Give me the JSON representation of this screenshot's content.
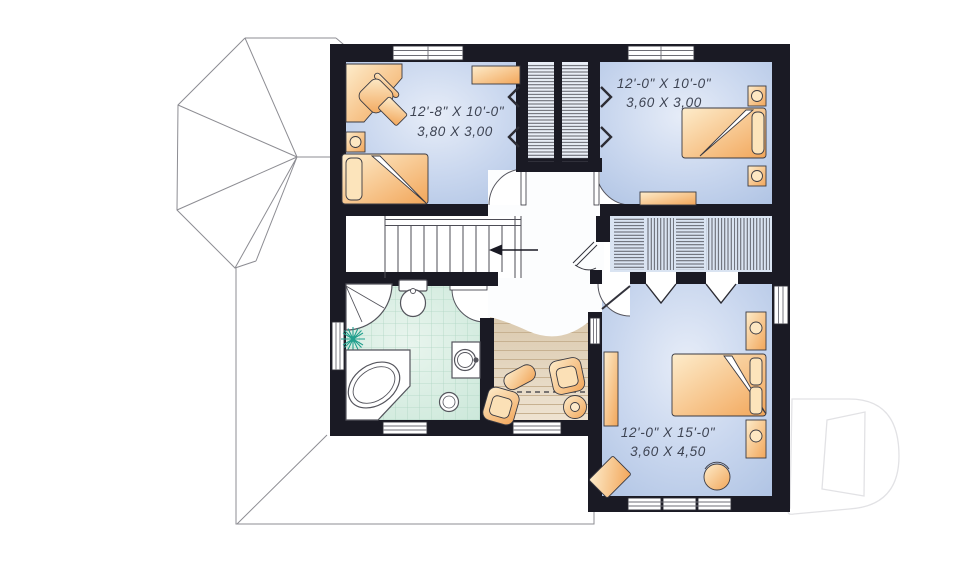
{
  "plan": {
    "type": "second-floor-plan",
    "rooms": [
      {
        "name": "bedroom-1",
        "imperial": "12'-8\" X 10'-0\"",
        "metric": "3,80 X 3,00"
      },
      {
        "name": "bedroom-2",
        "imperial": "12'-0\" X 10'-0\"",
        "metric": "3,60 X 3,00"
      },
      {
        "name": "bedroom-3",
        "imperial": "12'-0\" X 15'-0\"",
        "metric": "3,60 X 4,50"
      }
    ],
    "stairs_direction": "left",
    "logo_letter": "D",
    "colors": {
      "wall": "#1a1a24",
      "bedroom_floor": "#c4d3ec",
      "bathroom_floor": "#d6ede2",
      "wood_floor": "#e5d7c0",
      "furniture": "#f5b469",
      "plant_accent": "#21a08e",
      "roof_line": "#8d8d93",
      "logo_line": "#e2e2e5"
    }
  }
}
